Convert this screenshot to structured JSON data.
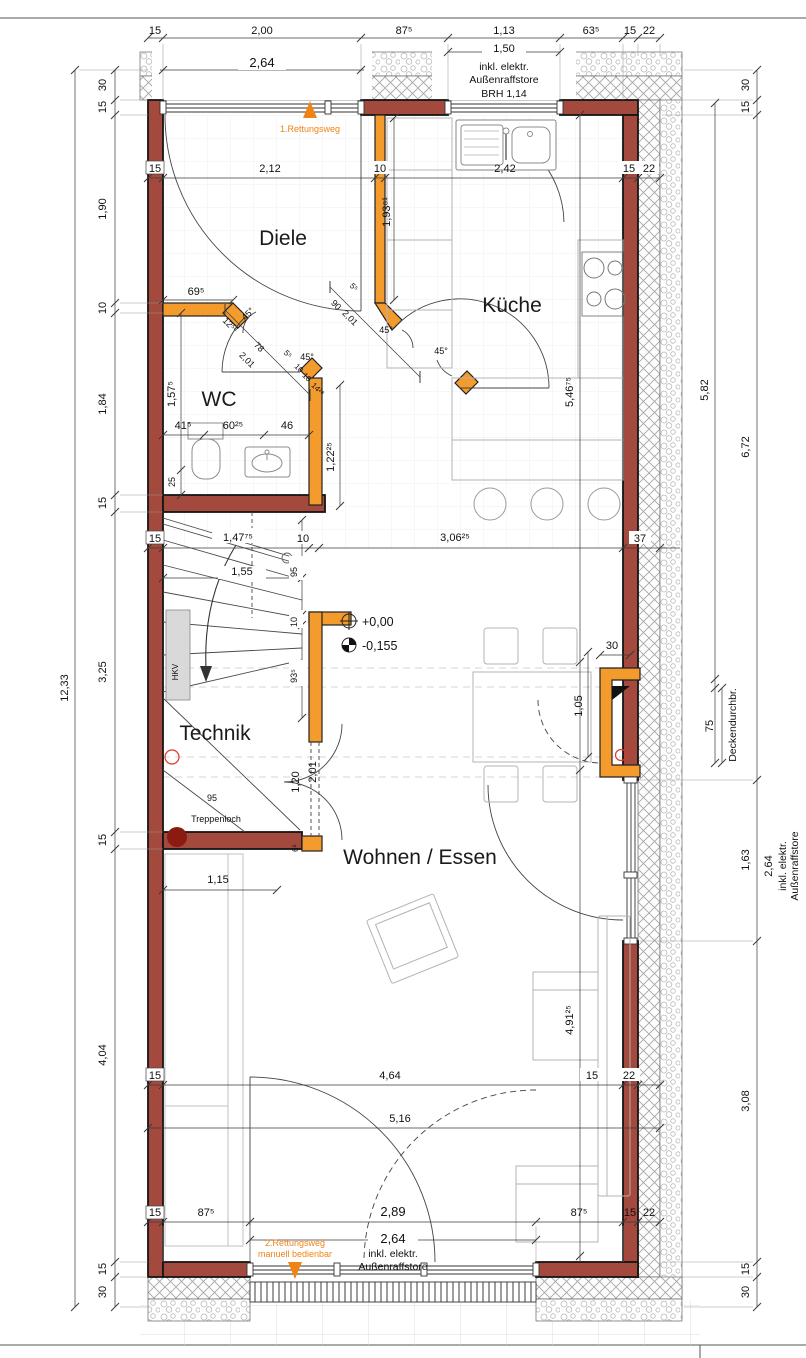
{
  "colors": {
    "wall": "#a3493d",
    "orange_wall": "#f49b2e",
    "escape_orange": "#ef8316",
    "marker_red": "#8b1a10",
    "hkv_fill": "#d9d9d9"
  },
  "rooms": {
    "diele": "Diele",
    "kueche": "Küche",
    "wc": "WC",
    "technik": "Technik",
    "wohnen": "Wohnen / Essen"
  },
  "labels": {
    "rettungsweg1": "1.Rettungsweg",
    "rettungsweg2_line1": "2.Rettungsweg",
    "rettungsweg2_line2": "manuell bedienbar",
    "treppenloch": "Treppenloch",
    "treppenloch_95": "95",
    "hkv": "HKV",
    "level_zero": "+0,00",
    "level_minus": "-0,155",
    "deckendurchbruch": "Deckendurchbr."
  },
  "dims": {
    "top_chain": [
      "15",
      "2,00",
      "87⁵",
      "1,13",
      "63⁵",
      "15",
      "22"
    ],
    "top_window": "2,64",
    "kitchen_window": {
      "width": "1,50",
      "note1": "inkl. elektr.",
      "note2": "Außenraffstore",
      "note3": "BRH 1,14"
    },
    "left_total": "12,33",
    "left_chain": [
      "30",
      "15",
      "1,90",
      "10",
      "1,84",
      "15",
      "3,25",
      "15",
      "4,04",
      "15",
      "30"
    ],
    "right_chain": [
      "30",
      "15",
      "6,72",
      "1,63",
      "3,08",
      "15",
      "30"
    ],
    "right_inner": {
      "d582": "5,82",
      "d75": "75"
    },
    "right_window": {
      "width": "2,64",
      "note1": "inkl. elektr.",
      "note2": "Außenraffstore"
    },
    "bottom_chain": [
      "15",
      "87⁵",
      "2,89",
      "87⁵",
      "15",
      "22"
    ],
    "bottom_window": {
      "width": "2,64",
      "note1": "inkl. elektr.",
      "note2": "Außenraffstore"
    },
    "hall_row": [
      "15",
      "2,12",
      "10",
      "2,42",
      "15",
      "22"
    ],
    "mid_row": [
      "15",
      "1,47⁷⁵",
      "10",
      "3,06²⁵",
      "37"
    ],
    "living_row": [
      "15",
      "4,64",
      "15",
      "22"
    ],
    "living_width": "5,16",
    "wc_row": [
      "41⁵",
      "60²⁵",
      "46"
    ],
    "wc_height": "1,57⁵",
    "wc_25": "25",
    "wc_right": "1,22²⁵",
    "hall_69": "69⁵",
    "hall_v": "1,93⁸¹",
    "kitchen_v": "5,46⁷⁵",
    "stair": {
      "d155": "1,55",
      "d95": "95",
      "d10": "10",
      "d935": "93⁵",
      "d120": "1,20",
      "d201": "2,01",
      "d65": "6⁵",
      "d115": "1,15"
    },
    "living": {
      "sofa": "4,91²⁵",
      "niche_w": "30",
      "niche_h": "1,05"
    },
    "diag": {
      "deg45": "45°",
      "d90": "90",
      "d201": "2,01",
      "d78": "78",
      "d55": "5⁵",
      "d1253": "12⁵³",
      "d10": "10",
      "d1428": "14²⁸"
    }
  }
}
